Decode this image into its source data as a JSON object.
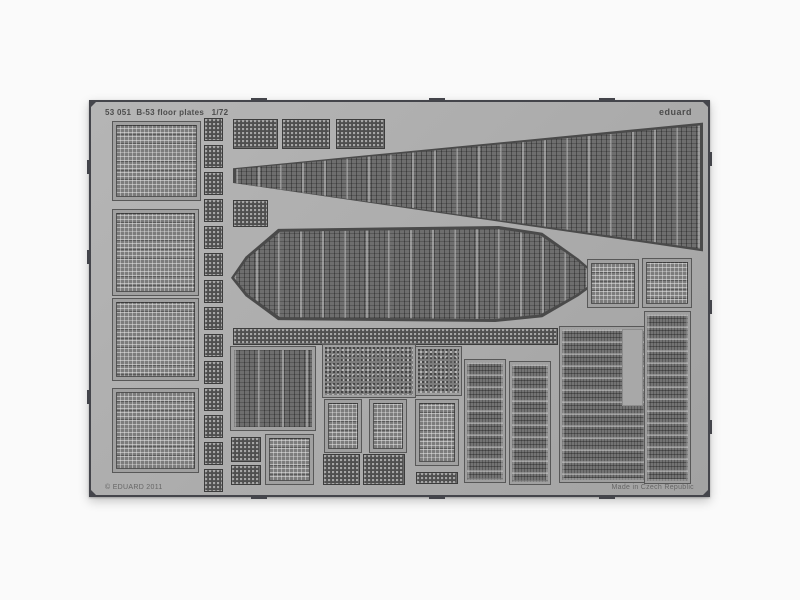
{
  "sheet": {
    "title_left": "53 051  B-53 floor plates   1/72",
    "brand": "eduard",
    "copyright": "© EDUARD 2011",
    "made_in": "Made in Czech Republic",
    "description": "photo-etched metal fret with floor-plate grating parts",
    "parts": [
      {
        "name": "floor-panel-1",
        "pattern": "grid",
        "x": 22,
        "y": 20,
        "w": 87,
        "h": 78
      },
      {
        "name": "floor-panel-2",
        "pattern": "grid",
        "x": 22,
        "y": 108,
        "w": 85,
        "h": 85
      },
      {
        "name": "floor-panel-3",
        "pattern": "grid",
        "x": 22,
        "y": 197,
        "w": 85,
        "h": 81
      },
      {
        "name": "floor-panel-4",
        "pattern": "grid",
        "x": 22,
        "y": 287,
        "w": 85,
        "h": 83
      },
      {
        "name": "strip-1",
        "pattern": "mesh",
        "x": 113,
        "y": 16,
        "w": 19,
        "h": 23
      },
      {
        "name": "strip-2",
        "pattern": "mesh",
        "x": 113,
        "y": 43,
        "w": 19,
        "h": 23
      },
      {
        "name": "strip-3",
        "pattern": "mesh",
        "x": 113,
        "y": 70,
        "w": 19,
        "h": 23
      },
      {
        "name": "strip-4",
        "pattern": "mesh",
        "x": 113,
        "y": 97,
        "w": 19,
        "h": 23
      },
      {
        "name": "strip-5",
        "pattern": "mesh",
        "x": 113,
        "y": 124,
        "w": 19,
        "h": 23
      },
      {
        "name": "strip-6",
        "pattern": "mesh",
        "x": 113,
        "y": 151,
        "w": 19,
        "h": 23
      },
      {
        "name": "strip-7",
        "pattern": "mesh",
        "x": 113,
        "y": 178,
        "w": 19,
        "h": 23
      },
      {
        "name": "strip-8",
        "pattern": "mesh",
        "x": 113,
        "y": 205,
        "w": 19,
        "h": 23
      },
      {
        "name": "strip-9",
        "pattern": "mesh",
        "x": 113,
        "y": 232,
        "w": 19,
        "h": 23
      },
      {
        "name": "strip-10",
        "pattern": "mesh",
        "x": 113,
        "y": 259,
        "w": 19,
        "h": 23
      },
      {
        "name": "strip-11",
        "pattern": "mesh",
        "x": 113,
        "y": 286,
        "w": 19,
        "h": 23
      },
      {
        "name": "strip-12",
        "pattern": "mesh",
        "x": 113,
        "y": 313,
        "w": 19,
        "h": 23
      },
      {
        "name": "strip-13",
        "pattern": "mesh",
        "x": 113,
        "y": 340,
        "w": 19,
        "h": 23
      },
      {
        "name": "strip-14",
        "pattern": "mesh",
        "x": 113,
        "y": 367,
        "w": 19,
        "h": 23
      },
      {
        "name": "mesh-plate-1",
        "pattern": "mesh",
        "x": 142,
        "y": 17,
        "w": 45,
        "h": 30
      },
      {
        "name": "mesh-plate-2",
        "pattern": "mesh",
        "x": 191,
        "y": 17,
        "w": 48,
        "h": 30
      },
      {
        "name": "mesh-plate-3",
        "pattern": "mesh",
        "x": 245,
        "y": 17,
        "w": 49,
        "h": 30
      },
      {
        "name": "mesh-plate-4",
        "pattern": "mesh",
        "x": 142,
        "y": 98,
        "w": 35,
        "h": 27
      },
      {
        "name": "tapered-walkway",
        "pattern": "poly",
        "x": 142,
        "y": 18,
        "w": 470,
        "h": 134,
        "clip": "polygon(0% 36%, 100% 2%, 100% 98%, 0% 47%)"
      },
      {
        "name": "octagon-deck",
        "pattern": "poly",
        "x": 140,
        "y": 124,
        "w": 362,
        "h": 96,
        "clip": "polygon(0% 54%, 4% 32%, 13% 3%, 74% 0%, 86% 7%, 96% 34%, 100% 47%, 100% 62%, 96% 73%, 86% 95%, 73% 100%, 13% 98%, 4% 73%)"
      },
      {
        "name": "mesh-strip-long",
        "pattern": "mesh",
        "x": 142,
        "y": 226,
        "w": 325,
        "h": 17
      },
      {
        "name": "walkway-panel",
        "pattern": "vstripes",
        "x": 140,
        "y": 245,
        "w": 84,
        "h": 83
      },
      {
        "name": "speckle-panel-wide",
        "pattern": "speckle",
        "x": 232,
        "y": 243,
        "w": 92,
        "h": 52
      },
      {
        "name": "speckle-panel-small",
        "pattern": "speckle",
        "x": 325,
        "y": 245,
        "w": 45,
        "h": 48
      },
      {
        "name": "grate-small-1",
        "pattern": "grid",
        "x": 234,
        "y": 298,
        "w": 36,
        "h": 52
      },
      {
        "name": "grate-small-2",
        "pattern": "grid",
        "x": 279,
        "y": 298,
        "w": 36,
        "h": 52
      },
      {
        "name": "grate-small-3",
        "pattern": "grid",
        "x": 325,
        "y": 298,
        "w": 42,
        "h": 65
      },
      {
        "name": "mesh-small-1",
        "pattern": "mesh",
        "x": 140,
        "y": 335,
        "w": 30,
        "h": 25
      },
      {
        "name": "mesh-small-2",
        "pattern": "mesh",
        "x": 140,
        "y": 363,
        "w": 30,
        "h": 20
      },
      {
        "name": "dense-grid-panel",
        "pattern": "grid",
        "x": 175,
        "y": 333,
        "w": 47,
        "h": 49
      },
      {
        "name": "mesh-small-3",
        "pattern": "mesh",
        "x": 232,
        "y": 352,
        "w": 37,
        "h": 31
      },
      {
        "name": "mesh-small-4",
        "pattern": "mesh",
        "x": 272,
        "y": 352,
        "w": 42,
        "h": 31
      },
      {
        "name": "mesh-small-5",
        "pattern": "mesh",
        "x": 325,
        "y": 370,
        "w": 42,
        "h": 12
      },
      {
        "name": "ladder-panel-1",
        "pattern": "hstripes",
        "x": 374,
        "y": 258,
        "w": 40,
        "h": 122
      },
      {
        "name": "ladder-panel-2",
        "pattern": "hstripes",
        "x": 419,
        "y": 260,
        "w": 40,
        "h": 122
      },
      {
        "name": "square-grate-1",
        "pattern": "grid",
        "x": 497,
        "y": 158,
        "w": 50,
        "h": 47
      },
      {
        "name": "square-grate-2",
        "pattern": "grid",
        "x": 552,
        "y": 157,
        "w": 48,
        "h": 48
      },
      {
        "name": "large-right-panel",
        "pattern": "hstripes",
        "x": 469,
        "y": 225,
        "w": 87,
        "h": 155
      },
      {
        "name": "blank-notch",
        "pattern": "blank",
        "x": 531,
        "y": 227,
        "w": 21,
        "h": 77
      },
      {
        "name": "tall-right-panel",
        "pattern": "hstripes",
        "x": 554,
        "y": 210,
        "w": 45,
        "h": 171
      }
    ],
    "edge_tabs": {
      "top_x": [
        160,
        338,
        508
      ],
      "bottom_x": [
        160,
        338,
        508
      ],
      "left_y": [
        58,
        148,
        288
      ],
      "right_y": [
        50,
        198,
        318
      ]
    },
    "colors": {
      "background": "#fafafa",
      "sheet_grey": "#adadad",
      "edge_dark": "#44454b",
      "frame_grey": "#a0a0a0",
      "etch_dark": "#515151",
      "text_ink": "#4c4c4c"
    }
  }
}
